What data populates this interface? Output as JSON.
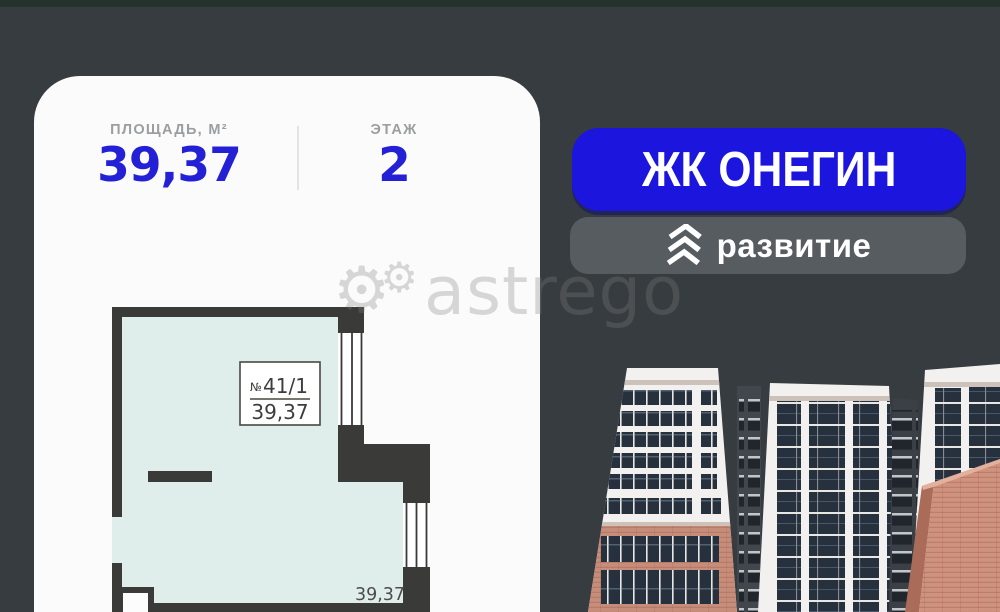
{
  "card": {
    "stats": {
      "area_label": "ПЛОЩАДЬ, М²",
      "area_value": "39,37",
      "floor_label": "ЭТАЖ",
      "floor_value": "2"
    },
    "plan": {
      "unit_no_sign": "№",
      "unit_number": "41/1",
      "unit_area": "39,37",
      "room_area_text": "39,37"
    }
  },
  "right_column": {
    "complex_name": "ЖК ОНЕГИН",
    "developer_name": "развитие",
    "developer_logo": "triple-chevron-up-icon"
  },
  "watermark": {
    "text": "astrego",
    "icon": "gear-icon",
    "gear_big": "⚙",
    "gear_small": "⚙"
  },
  "colors": {
    "page_background": "#363c3f",
    "top_strip": "#25332d",
    "accent_blue": "#1b15dd",
    "stat_blue": "#2320d6",
    "badge_gray": "#565c5f",
    "plan_room_fill": "#dfeeea",
    "plan_wall": "#3a3a38",
    "brick": "#c68d7a"
  }
}
